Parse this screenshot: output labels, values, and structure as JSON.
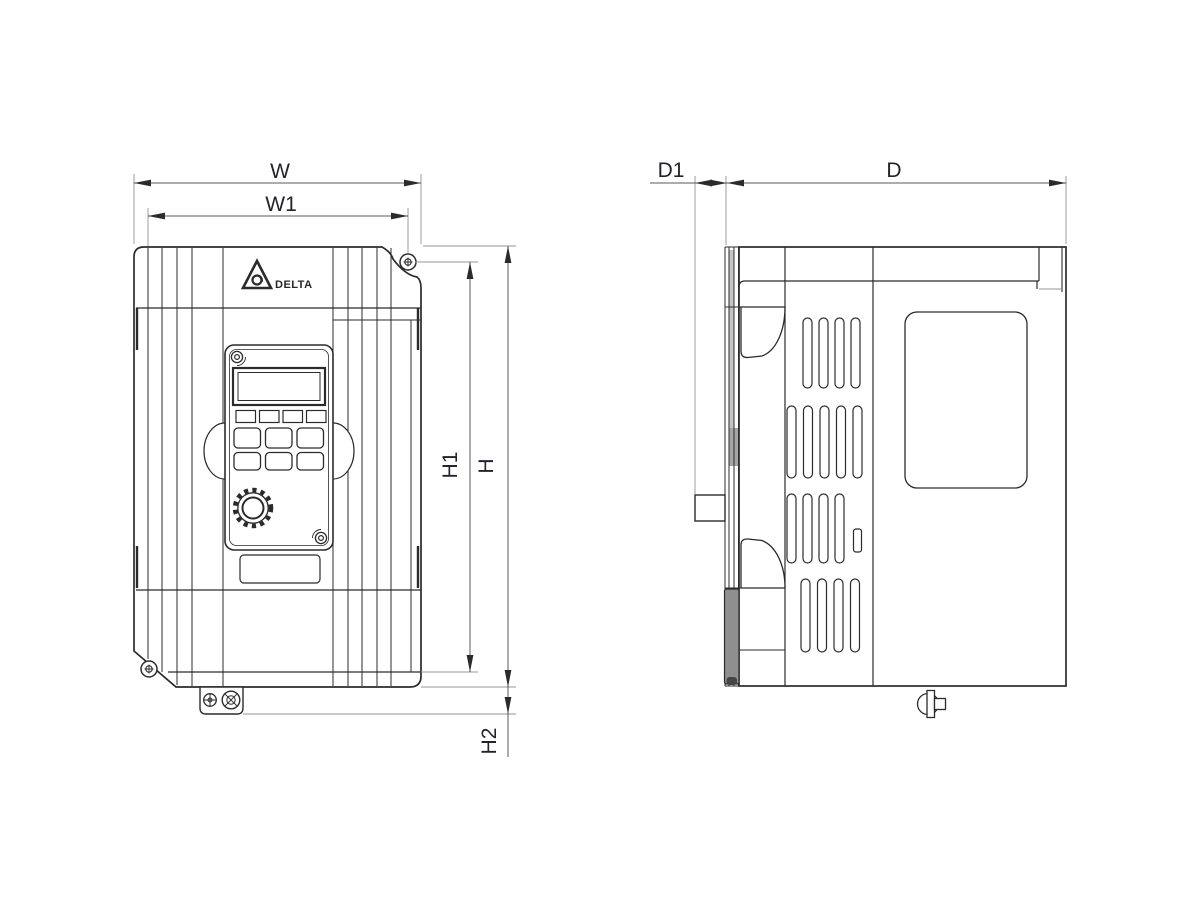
{
  "labels": {
    "W": "W",
    "W1": "W1",
    "H1": "H1",
    "H": "H",
    "H2": "H2",
    "D1": "D1",
    "D": "D"
  },
  "logo": {
    "brand": "DELTA"
  },
  "colors": {
    "background": "#ffffff",
    "outline": "#2b2b2b",
    "dimension": "#5a5a5a",
    "extension": "#949494",
    "label_text": "#23232e",
    "shading": "#c4c4c4"
  }
}
